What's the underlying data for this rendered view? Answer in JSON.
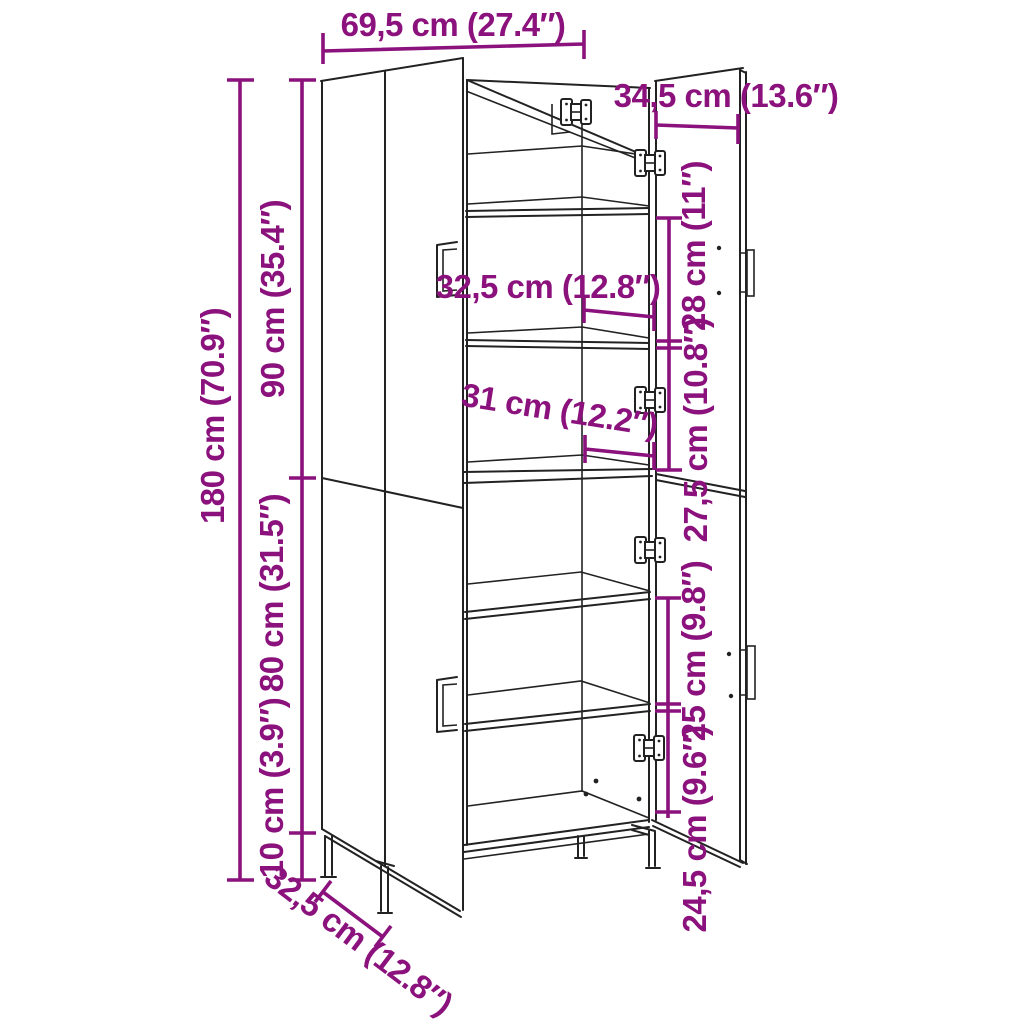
{
  "colors": {
    "dimension": "#8B117D",
    "line_art": "#222222",
    "background": "#ffffff"
  },
  "diagram": {
    "labels": {
      "overall_width": "69,5 cm (27.4″)",
      "door_width": "34,5 cm (13.6″)",
      "overall_height": "180 cm (70.9″)",
      "upper_section_height": "90 cm (35.4″)",
      "lower_section_height": "80 cm (31.5″)",
      "leg_height": "10 cm (3.9″)",
      "inner_width_upper": "32,5 cm (12.8″)",
      "inner_width_lower": "31 cm (12.2″)",
      "shelf_gap_top": "28 cm (11″)",
      "shelf_gap_upper_mid": "27,5 cm (10.8″)",
      "shelf_gap_lower_mid": "25 cm (9.8″)",
      "shelf_gap_bottom": "24,5 cm (9.6″)",
      "depth": "32,5 cm (12.8″)"
    }
  }
}
